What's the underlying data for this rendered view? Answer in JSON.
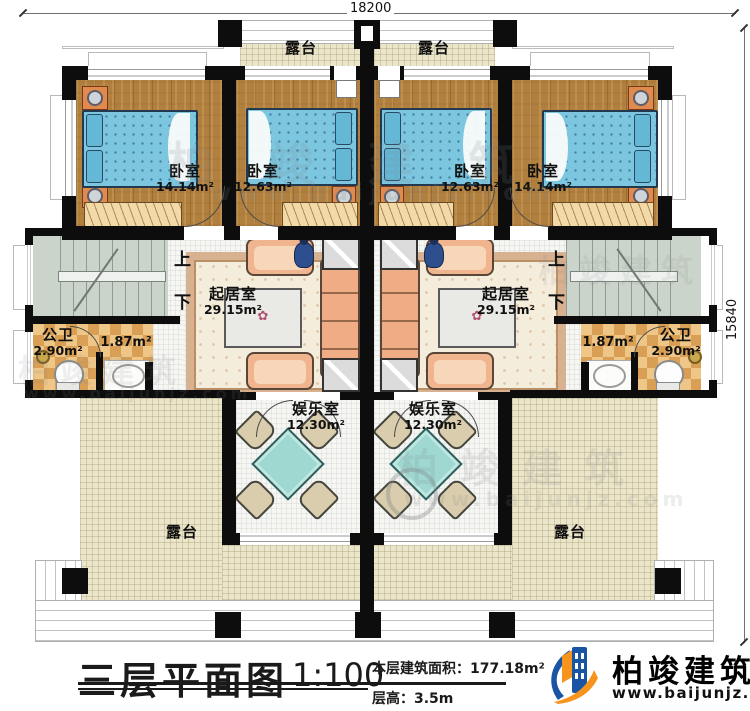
{
  "dimensions": {
    "width_mm": "18200",
    "height_mm": "15840"
  },
  "rooms": {
    "terrace": {
      "name": "露台"
    },
    "bedroom_large": {
      "name": "卧室",
      "area": "14.14m²"
    },
    "bedroom_small": {
      "name": "卧室",
      "area": "12.63m²"
    },
    "living": {
      "name": "起居室",
      "area": "29.15m²"
    },
    "bath": {
      "name": "公卫",
      "area": "2.90m²"
    },
    "vanity": {
      "area": "1.87m²"
    },
    "entertainment": {
      "name": "娱乐室",
      "area": "12.30m²"
    }
  },
  "stairs": {
    "up": "上",
    "down": "下"
  },
  "title_block": {
    "title": "三层平面图",
    "scale": "1:100",
    "area_label": "本层建筑面积：",
    "area_value": "177.18m²",
    "height_label": "层高：",
    "height_value": "3.5m"
  },
  "brand": {
    "name": "柏竣建筑",
    "website": "www.baijunjz.com"
  },
  "watermark": {
    "name": "柏竣建筑",
    "website": "www.baijunjz.com"
  },
  "colors": {
    "wall": "#0d0d0d",
    "wood_floor": "#b2803e",
    "terrace_tile": "#ebe5ca",
    "bath_tile": "#d89f55",
    "bed": "#7cc6df",
    "logo_blue": "#1a55a3",
    "logo_orange": "#f7941d"
  }
}
